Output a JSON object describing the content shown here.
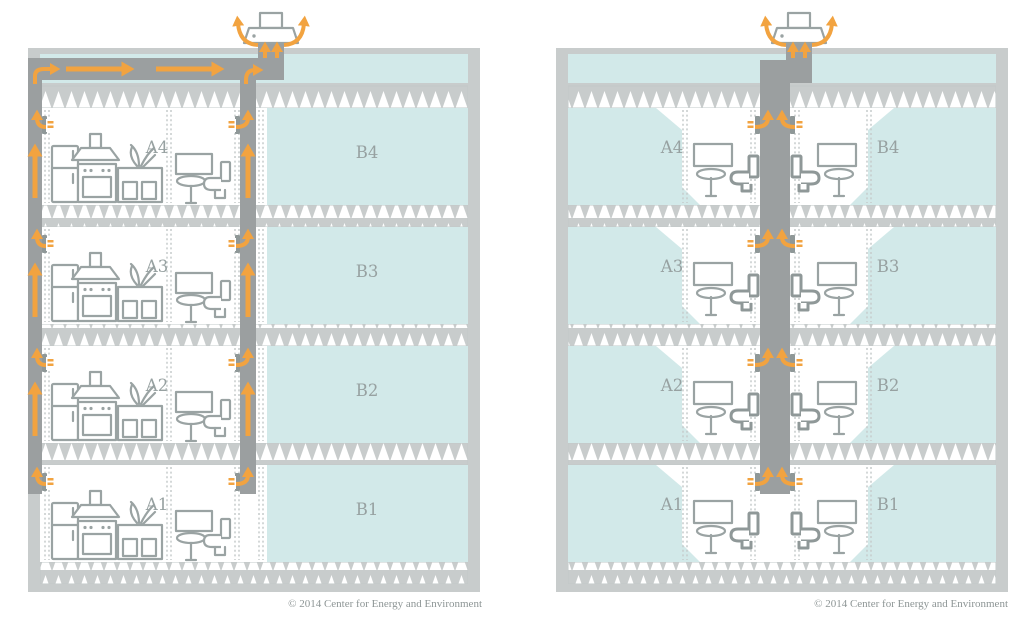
{
  "left_diagram": {
    "floors_top_to_bottom": [
      {
        "unit_a": "A4",
        "unit_b": "B4"
      },
      {
        "unit_a": "A3",
        "unit_b": "B3"
      },
      {
        "unit_a": "A2",
        "unit_b": "B2"
      },
      {
        "unit_a": "A1",
        "unit_b": "B1"
      }
    ],
    "copyright": "© 2014 Center for Energy and Environment"
  },
  "right_diagram": {
    "floors_top_to_bottom": [
      {
        "unit_a": "A4",
        "unit_b": "B4"
      },
      {
        "unit_a": "A3",
        "unit_b": "B3"
      },
      {
        "unit_a": "A2",
        "unit_b": "B2"
      },
      {
        "unit_a": "A1",
        "unit_b": "B1"
      }
    ],
    "copyright": "© 2014 Center for Energy and Environment"
  },
  "icons": {
    "roof_fan": "exhaust-fan",
    "airflow": "orange-arrow",
    "vent": "wall-grille",
    "fixtures": [
      "refrigerator",
      "range-hood",
      "stove",
      "kitchen-sink-plant",
      "mirror",
      "bathroom-sink",
      "toilet"
    ]
  },
  "colors": {
    "airflow_orange": "#f2a340",
    "room_blue": "#d2e9e9",
    "duct_gray": "#9b9fa0",
    "structure_gray": "#c8cccc",
    "fixture_gray": "#9aa3a3",
    "label_gray": "#97a1a1",
    "copyright_gray": "#8d9595"
  }
}
